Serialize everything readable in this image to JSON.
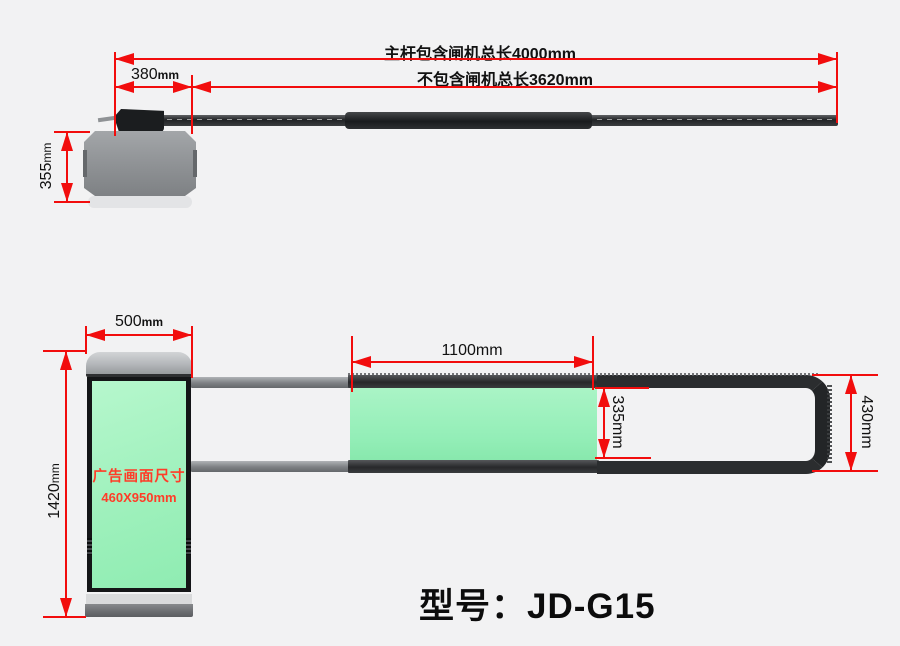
{
  "colors": {
    "background": "#f2f2f3",
    "dimension_red": "#f20d0d",
    "panel_green": "#9df0bb",
    "ad_text_red": "#ff3c28",
    "frame_dark": "#1b1d1f"
  },
  "model": {
    "label": "型号：JD-G15"
  },
  "top_view": {
    "total_length_label": "主杆包含闸机总长4000mm",
    "arm_length_label": "不包含闸机总长3620mm",
    "head_width": {
      "value": "380",
      "unit": "mm"
    },
    "head_depth": {
      "value": "355",
      "unit": "mm"
    }
  },
  "front_view": {
    "cabinet_width": {
      "value": "500",
      "unit": "mm"
    },
    "cabinet_height": {
      "value": "1420",
      "unit": "mm"
    },
    "ad_panel_length_label": "1100mm",
    "ad_panel_height_label": "335mm",
    "arm_end_height_label": "430mm",
    "ad_area": {
      "line1": "广告画面尺寸",
      "line2": "460X950mm"
    }
  }
}
